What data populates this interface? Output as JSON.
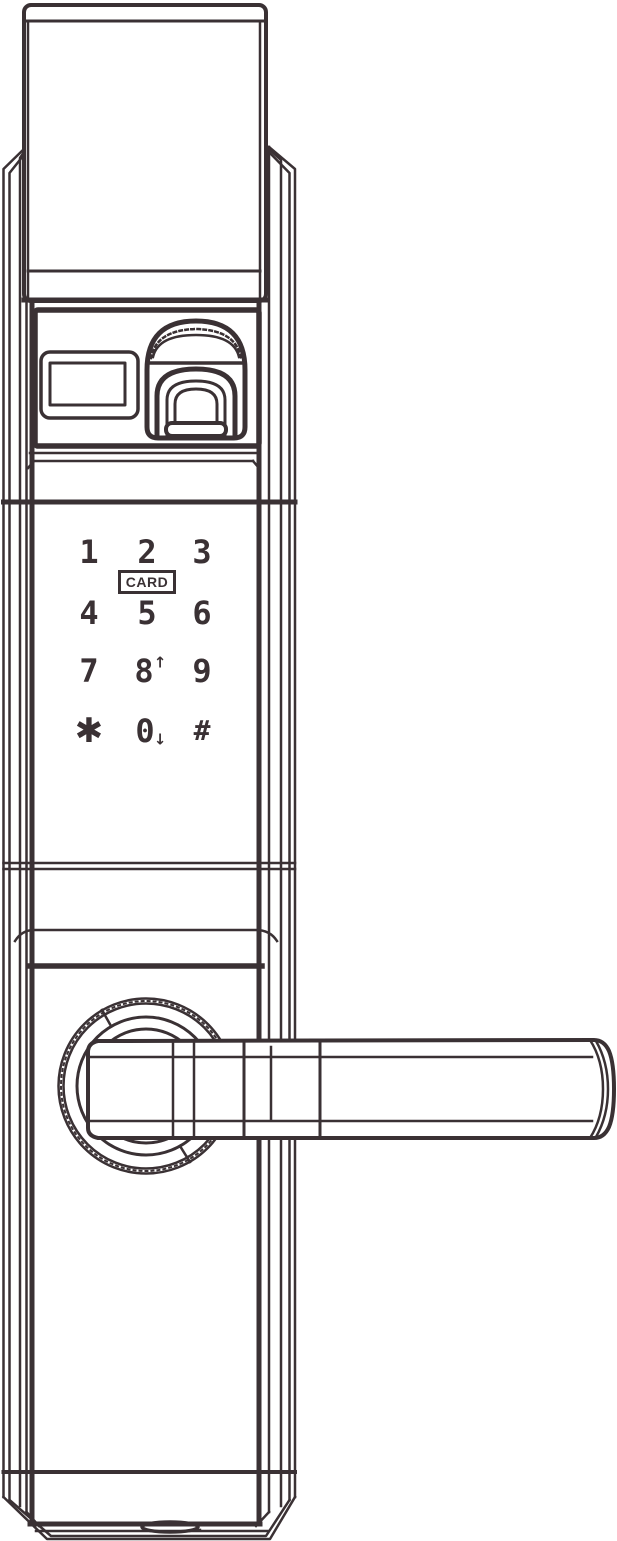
{
  "colors": {
    "line": "#3a3134",
    "background": "#ffffff"
  },
  "keypad": {
    "card_label": "CARD",
    "keys": [
      {
        "id": "1",
        "label": "1"
      },
      {
        "id": "2",
        "label": "2"
      },
      {
        "id": "3",
        "label": "3"
      },
      {
        "id": "4",
        "label": "4"
      },
      {
        "id": "5",
        "label": "5"
      },
      {
        "id": "6",
        "label": "6"
      },
      {
        "id": "7",
        "label": "7"
      },
      {
        "id": "8",
        "label": "8",
        "arrow": "↑"
      },
      {
        "id": "9",
        "label": "9"
      },
      {
        "id": "star",
        "label": "✱"
      },
      {
        "id": "0",
        "label": "0",
        "arrow": "↓"
      },
      {
        "id": "hash",
        "label": "#"
      }
    ]
  }
}
